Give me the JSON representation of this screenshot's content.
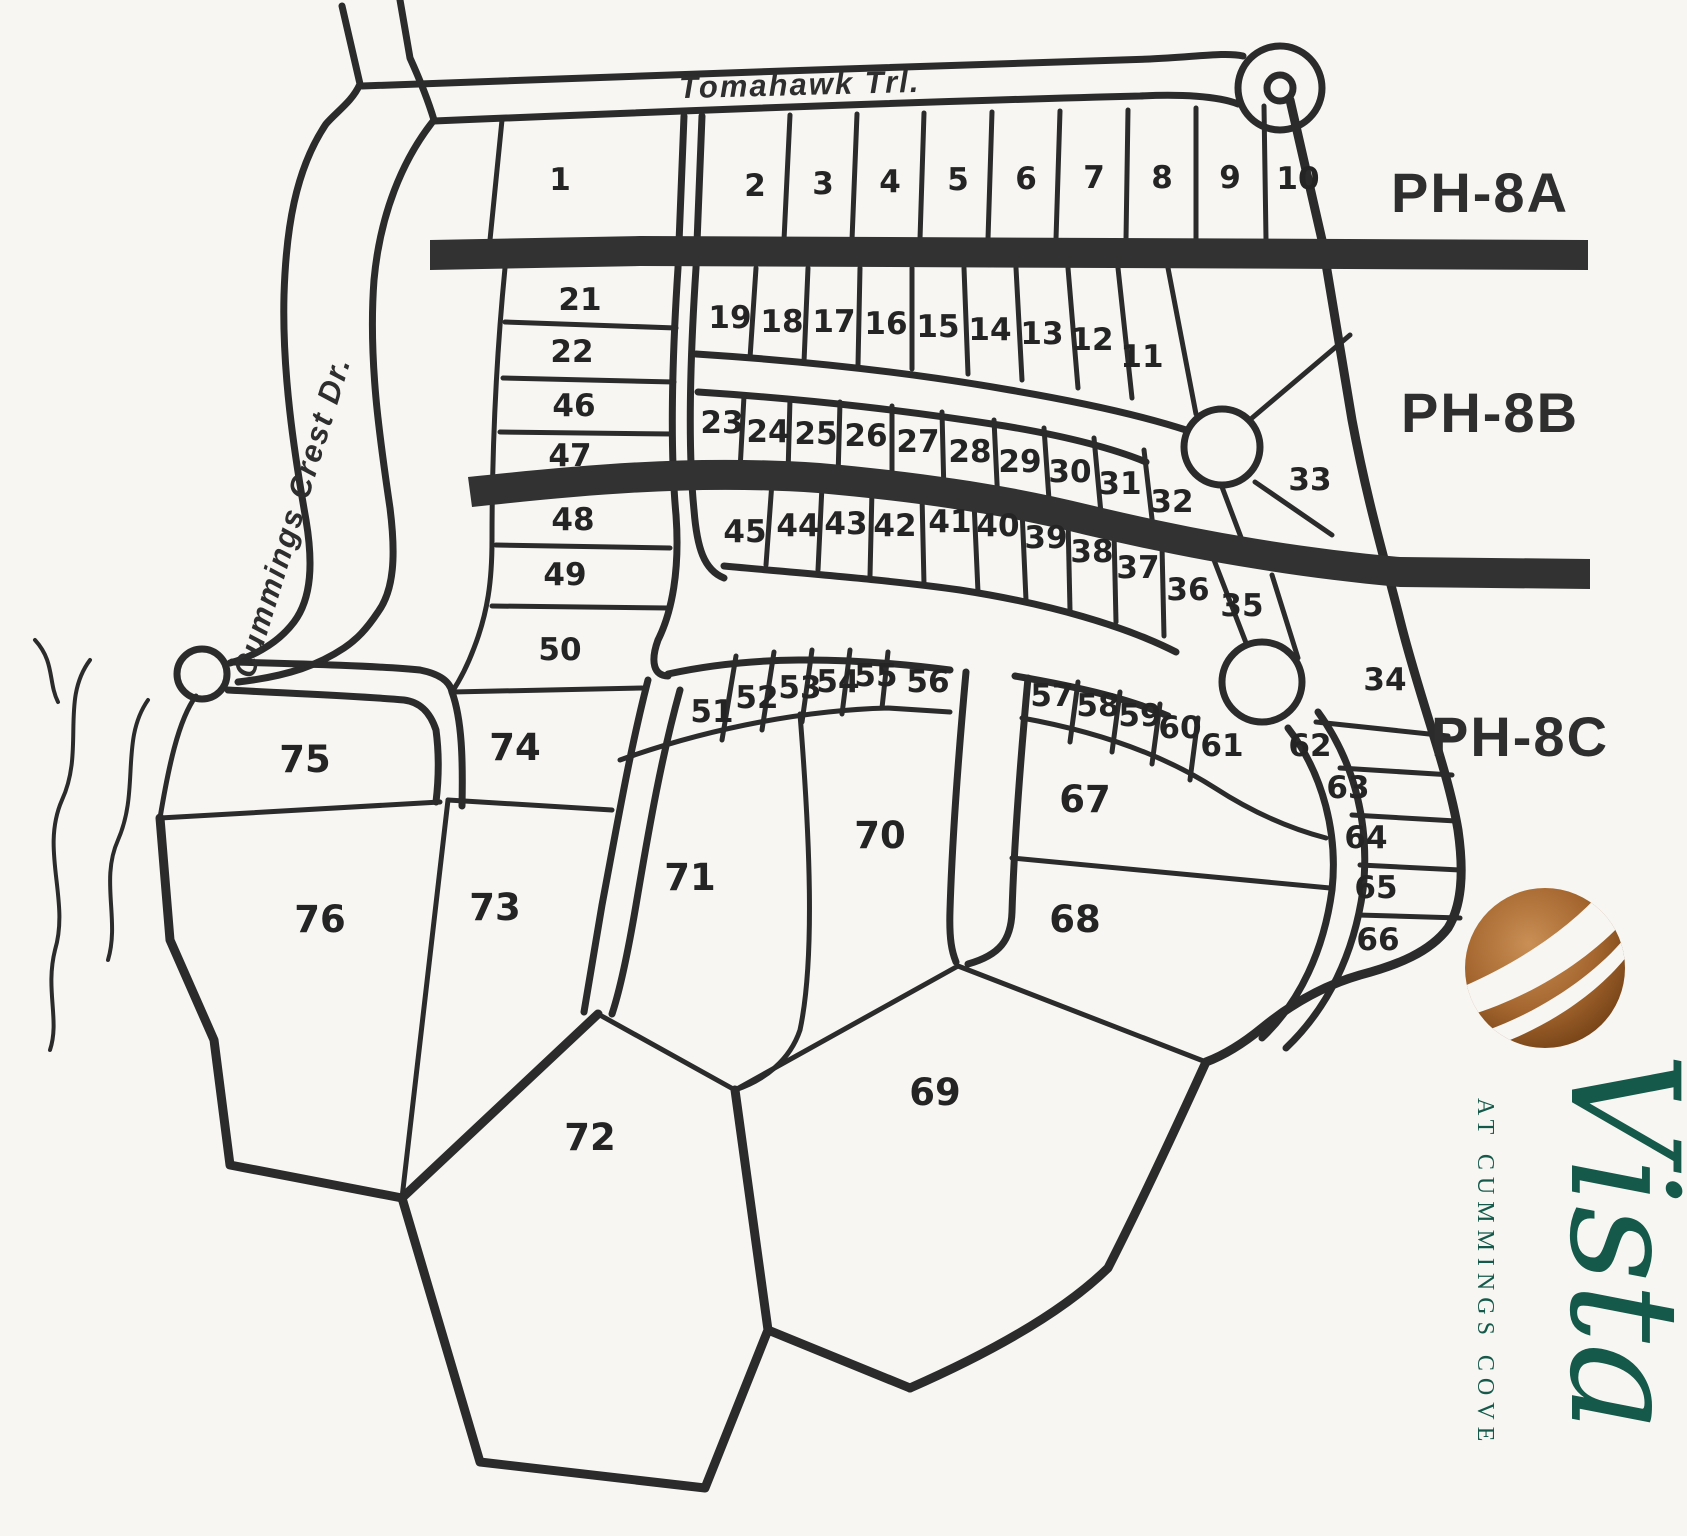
{
  "map": {
    "title": "Vista at Cummings Cove plat map",
    "streets": {
      "tomahawk": "Tomahawk Trl.",
      "cummings": "Cummings Crest Dr."
    },
    "phases": [
      {
        "label": "PH-8A"
      },
      {
        "label": "PH-8B"
      },
      {
        "label": "PH-8C"
      }
    ],
    "lots": [
      {
        "n": "1",
        "x": 560,
        "y": 190
      },
      {
        "n": "2",
        "x": 755,
        "y": 196
      },
      {
        "n": "3",
        "x": 823,
        "y": 194
      },
      {
        "n": "4",
        "x": 890,
        "y": 192
      },
      {
        "n": "5",
        "x": 958,
        "y": 190
      },
      {
        "n": "6",
        "x": 1026,
        "y": 189
      },
      {
        "n": "7",
        "x": 1094,
        "y": 188
      },
      {
        "n": "8",
        "x": 1162,
        "y": 188
      },
      {
        "n": "9",
        "x": 1230,
        "y": 188
      },
      {
        "n": "10",
        "x": 1298,
        "y": 189
      },
      {
        "n": "11",
        "x": 1142,
        "y": 367
      },
      {
        "n": "12",
        "x": 1092,
        "y": 350
      },
      {
        "n": "13",
        "x": 1042,
        "y": 344
      },
      {
        "n": "14",
        "x": 990,
        "y": 340
      },
      {
        "n": "15",
        "x": 938,
        "y": 337
      },
      {
        "n": "16",
        "x": 886,
        "y": 334
      },
      {
        "n": "17",
        "x": 834,
        "y": 332
      },
      {
        "n": "18",
        "x": 782,
        "y": 332
      },
      {
        "n": "19",
        "x": 730,
        "y": 328
      },
      {
        "n": "21",
        "x": 580,
        "y": 310
      },
      {
        "n": "22",
        "x": 572,
        "y": 362
      },
      {
        "n": "46",
        "x": 574,
        "y": 416
      },
      {
        "n": "47",
        "x": 570,
        "y": 466
      },
      {
        "n": "48",
        "x": 573,
        "y": 530
      },
      {
        "n": "49",
        "x": 565,
        "y": 585
      },
      {
        "n": "50",
        "x": 560,
        "y": 660
      },
      {
        "n": "23",
        "x": 722,
        "y": 433
      },
      {
        "n": "24",
        "x": 768,
        "y": 442
      },
      {
        "n": "25",
        "x": 816,
        "y": 444
      },
      {
        "n": "26",
        "x": 866,
        "y": 446
      },
      {
        "n": "27",
        "x": 918,
        "y": 452
      },
      {
        "n": "28",
        "x": 970,
        "y": 462
      },
      {
        "n": "29",
        "x": 1020,
        "y": 472
      },
      {
        "n": "30",
        "x": 1070,
        "y": 482
      },
      {
        "n": "31",
        "x": 1120,
        "y": 494
      },
      {
        "n": "32",
        "x": 1172,
        "y": 512
      },
      {
        "n": "33",
        "x": 1310,
        "y": 490
      },
      {
        "n": "34",
        "x": 1385,
        "y": 690
      },
      {
        "n": "45",
        "x": 745,
        "y": 542
      },
      {
        "n": "44",
        "x": 798,
        "y": 536
      },
      {
        "n": "43",
        "x": 846,
        "y": 534
      },
      {
        "n": "42",
        "x": 895,
        "y": 536
      },
      {
        "n": "41",
        "x": 950,
        "y": 532
      },
      {
        "n": "40",
        "x": 998,
        "y": 536
      },
      {
        "n": "39",
        "x": 1046,
        "y": 548
      },
      {
        "n": "38",
        "x": 1092,
        "y": 562
      },
      {
        "n": "37",
        "x": 1138,
        "y": 578
      },
      {
        "n": "36",
        "x": 1188,
        "y": 600
      },
      {
        "n": "35",
        "x": 1242,
        "y": 616
      },
      {
        "n": "51",
        "x": 712,
        "y": 722
      },
      {
        "n": "52",
        "x": 757,
        "y": 708
      },
      {
        "n": "53",
        "x": 800,
        "y": 698
      },
      {
        "n": "54",
        "x": 838,
        "y": 692
      },
      {
        "n": "55",
        "x": 876,
        "y": 686
      },
      {
        "n": "56",
        "x": 928,
        "y": 692
      },
      {
        "n": "57",
        "x": 1052,
        "y": 706
      },
      {
        "n": "58",
        "x": 1098,
        "y": 716
      },
      {
        "n": "59",
        "x": 1140,
        "y": 726
      },
      {
        "n": "60",
        "x": 1180,
        "y": 738
      },
      {
        "n": "61",
        "x": 1222,
        "y": 756
      },
      {
        "n": "62",
        "x": 1310,
        "y": 756
      },
      {
        "n": "63",
        "x": 1348,
        "y": 798
      },
      {
        "n": "64",
        "x": 1366,
        "y": 848
      },
      {
        "n": "65",
        "x": 1376,
        "y": 898
      },
      {
        "n": "66",
        "x": 1378,
        "y": 950
      },
      {
        "n": "67",
        "x": 1085,
        "y": 812,
        "big": true
      },
      {
        "n": "68",
        "x": 1075,
        "y": 932,
        "big": true
      },
      {
        "n": "69",
        "x": 935,
        "y": 1105,
        "big": true
      },
      {
        "n": "70",
        "x": 880,
        "y": 848,
        "big": true
      },
      {
        "n": "71",
        "x": 690,
        "y": 890,
        "big": true
      },
      {
        "n": "72",
        "x": 590,
        "y": 1150,
        "big": true
      },
      {
        "n": "73",
        "x": 495,
        "y": 920,
        "big": true
      },
      {
        "n": "74",
        "x": 515,
        "y": 760,
        "big": true
      },
      {
        "n": "75",
        "x": 305,
        "y": 772,
        "big": true
      },
      {
        "n": "76",
        "x": 320,
        "y": 932,
        "big": true
      }
    ]
  },
  "logo": {
    "brand": "Vista",
    "tagline": "AT CUMMINGS COVE",
    "ball_color": "#9c5d28",
    "text_color": "#15594a"
  }
}
